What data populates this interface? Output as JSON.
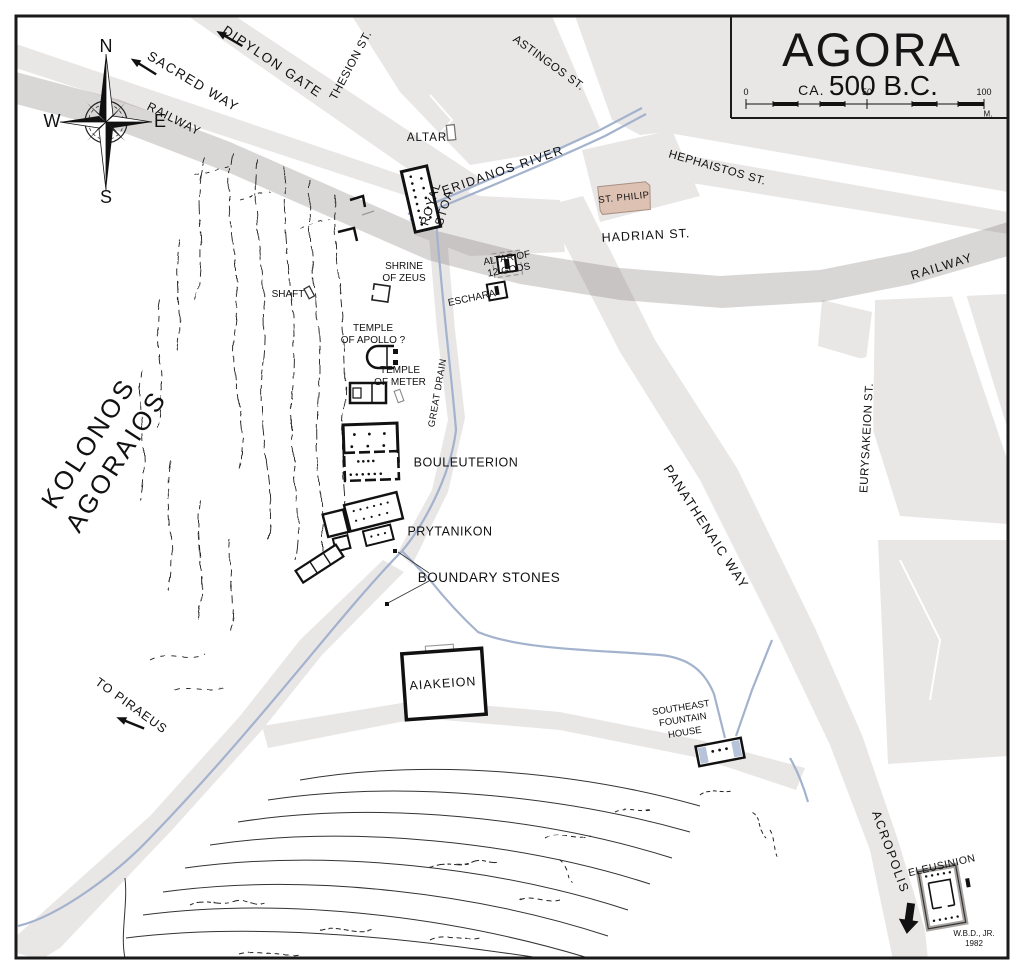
{
  "title": {
    "name": "AGORA",
    "ca": "CA.",
    "date": "500 B.C."
  },
  "scale_bar": {
    "start": "0",
    "mid": "50",
    "end": "100",
    "unit": "M."
  },
  "compass": {
    "n": "N",
    "s": "S",
    "e": "E",
    "w": "W"
  },
  "signature": {
    "author": "W.B.D., JR.",
    "year": "1982"
  },
  "colors": {
    "road": "#e9e6e6",
    "railway_overlay": "rgba(128,118,118,0.30)",
    "water": "#a3b2cd",
    "st_philip_fill": "#ddc2b4",
    "ink": "#111111"
  },
  "labels": {
    "sacred_way": "SACRED WAY",
    "dipylon_gate": "DIPYLON GATE",
    "railway_left": "RAILWAY",
    "railway_right": "RAILWAY",
    "thesion_st": "THESION ST.",
    "astingos_st": "ASTINGOS ST.",
    "altar": "ALTAR",
    "eridanos_river": "ERIDANOS RIVER",
    "royal_stoa": "ROYAL\nSTOA",
    "st_philip": "ST. PHILIP",
    "hadrian_st": "HADRIAN ST.",
    "hephaistos_st": "HEPHAISTOS ST.",
    "shrine_of_zeus": "SHRINE\nOF ZEUS",
    "shaft": "SHAFT",
    "altar_of_12_gods": "ALTAR OF\n12 GODS",
    "eschara": "ESCHARA",
    "temple_of_apollo": "TEMPLE\nOF APOLLO ?",
    "temple_of_meter": "TEMPLE\nOF METER",
    "great_drain": "GREAT DRAIN",
    "bouleuterion": "BOULEUTERION",
    "prytanikon": "PRYTANIKON",
    "boundary_stones": "BOUNDARY STONES",
    "kolonos_agoraios": "KOLONOS\nAGORAIOS",
    "aiakeion": "AIAKEION",
    "to_piraeus": "TO PIRAEUS",
    "se_fountain_house": "SOUTHEAST\nFOUNTAIN\nHOUSE",
    "panathenaic_way": "PANATHENAIC WAY",
    "eurysakeion_st": "EURYSAKEION ST.",
    "acropolis": "ACROPOLIS",
    "eleusinion": "ELEUSINION"
  }
}
